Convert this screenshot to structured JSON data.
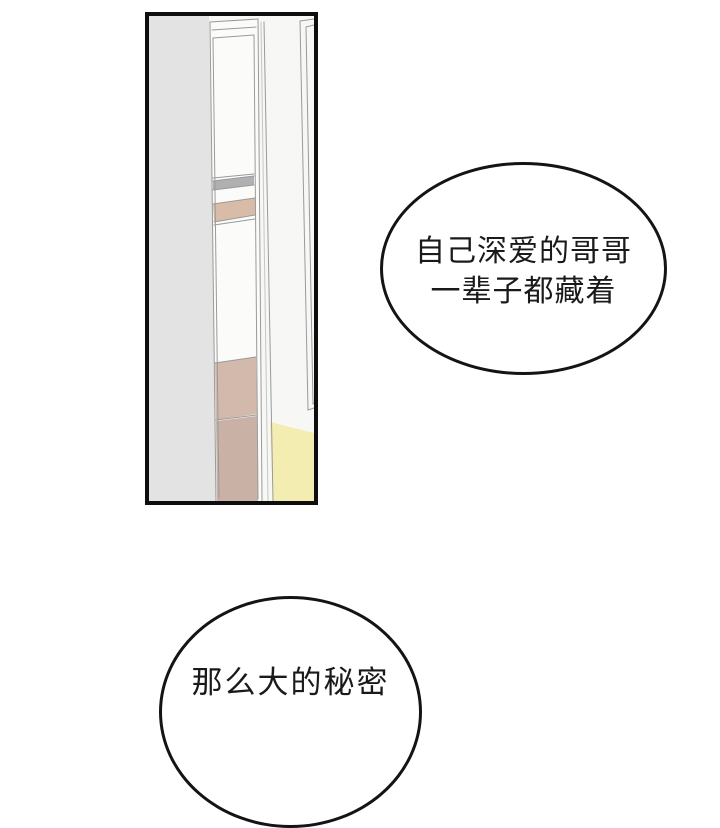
{
  "page": {
    "type": "comic-panel-page",
    "background": "#ffffff"
  },
  "panel": {
    "description": "tall vertical panel showing a wall corner with an open doorway, shelves and light on the floor",
    "border_color": "#0e0e0e",
    "colors": {
      "backdrop": "#f7f7f5",
      "wall": "#e3e3e4",
      "door_white": "#fbfbfa",
      "shelf_gray": "#b0b0b2",
      "shelf_tan": "#d8bca8",
      "panel_tan_upper": "#d3b9ab",
      "panel_tan_lower": "#c9b1a6",
      "floor_light_yellow": "#f4edb2",
      "line": "#9a9a9a",
      "line_soft": "#c6c6c6"
    }
  },
  "bubbles": [
    {
      "name": "speech-bubble-top",
      "lines": [
        "自己深爱的哥哥",
        "一辈子都藏着"
      ]
    },
    {
      "name": "speech-bubble-bottom",
      "lines": [
        "那么大的秘密"
      ]
    }
  ],
  "text_color": "#1a1a1a",
  "bubble_outline": "#141414",
  "bubble_fill": "#ffffff"
}
